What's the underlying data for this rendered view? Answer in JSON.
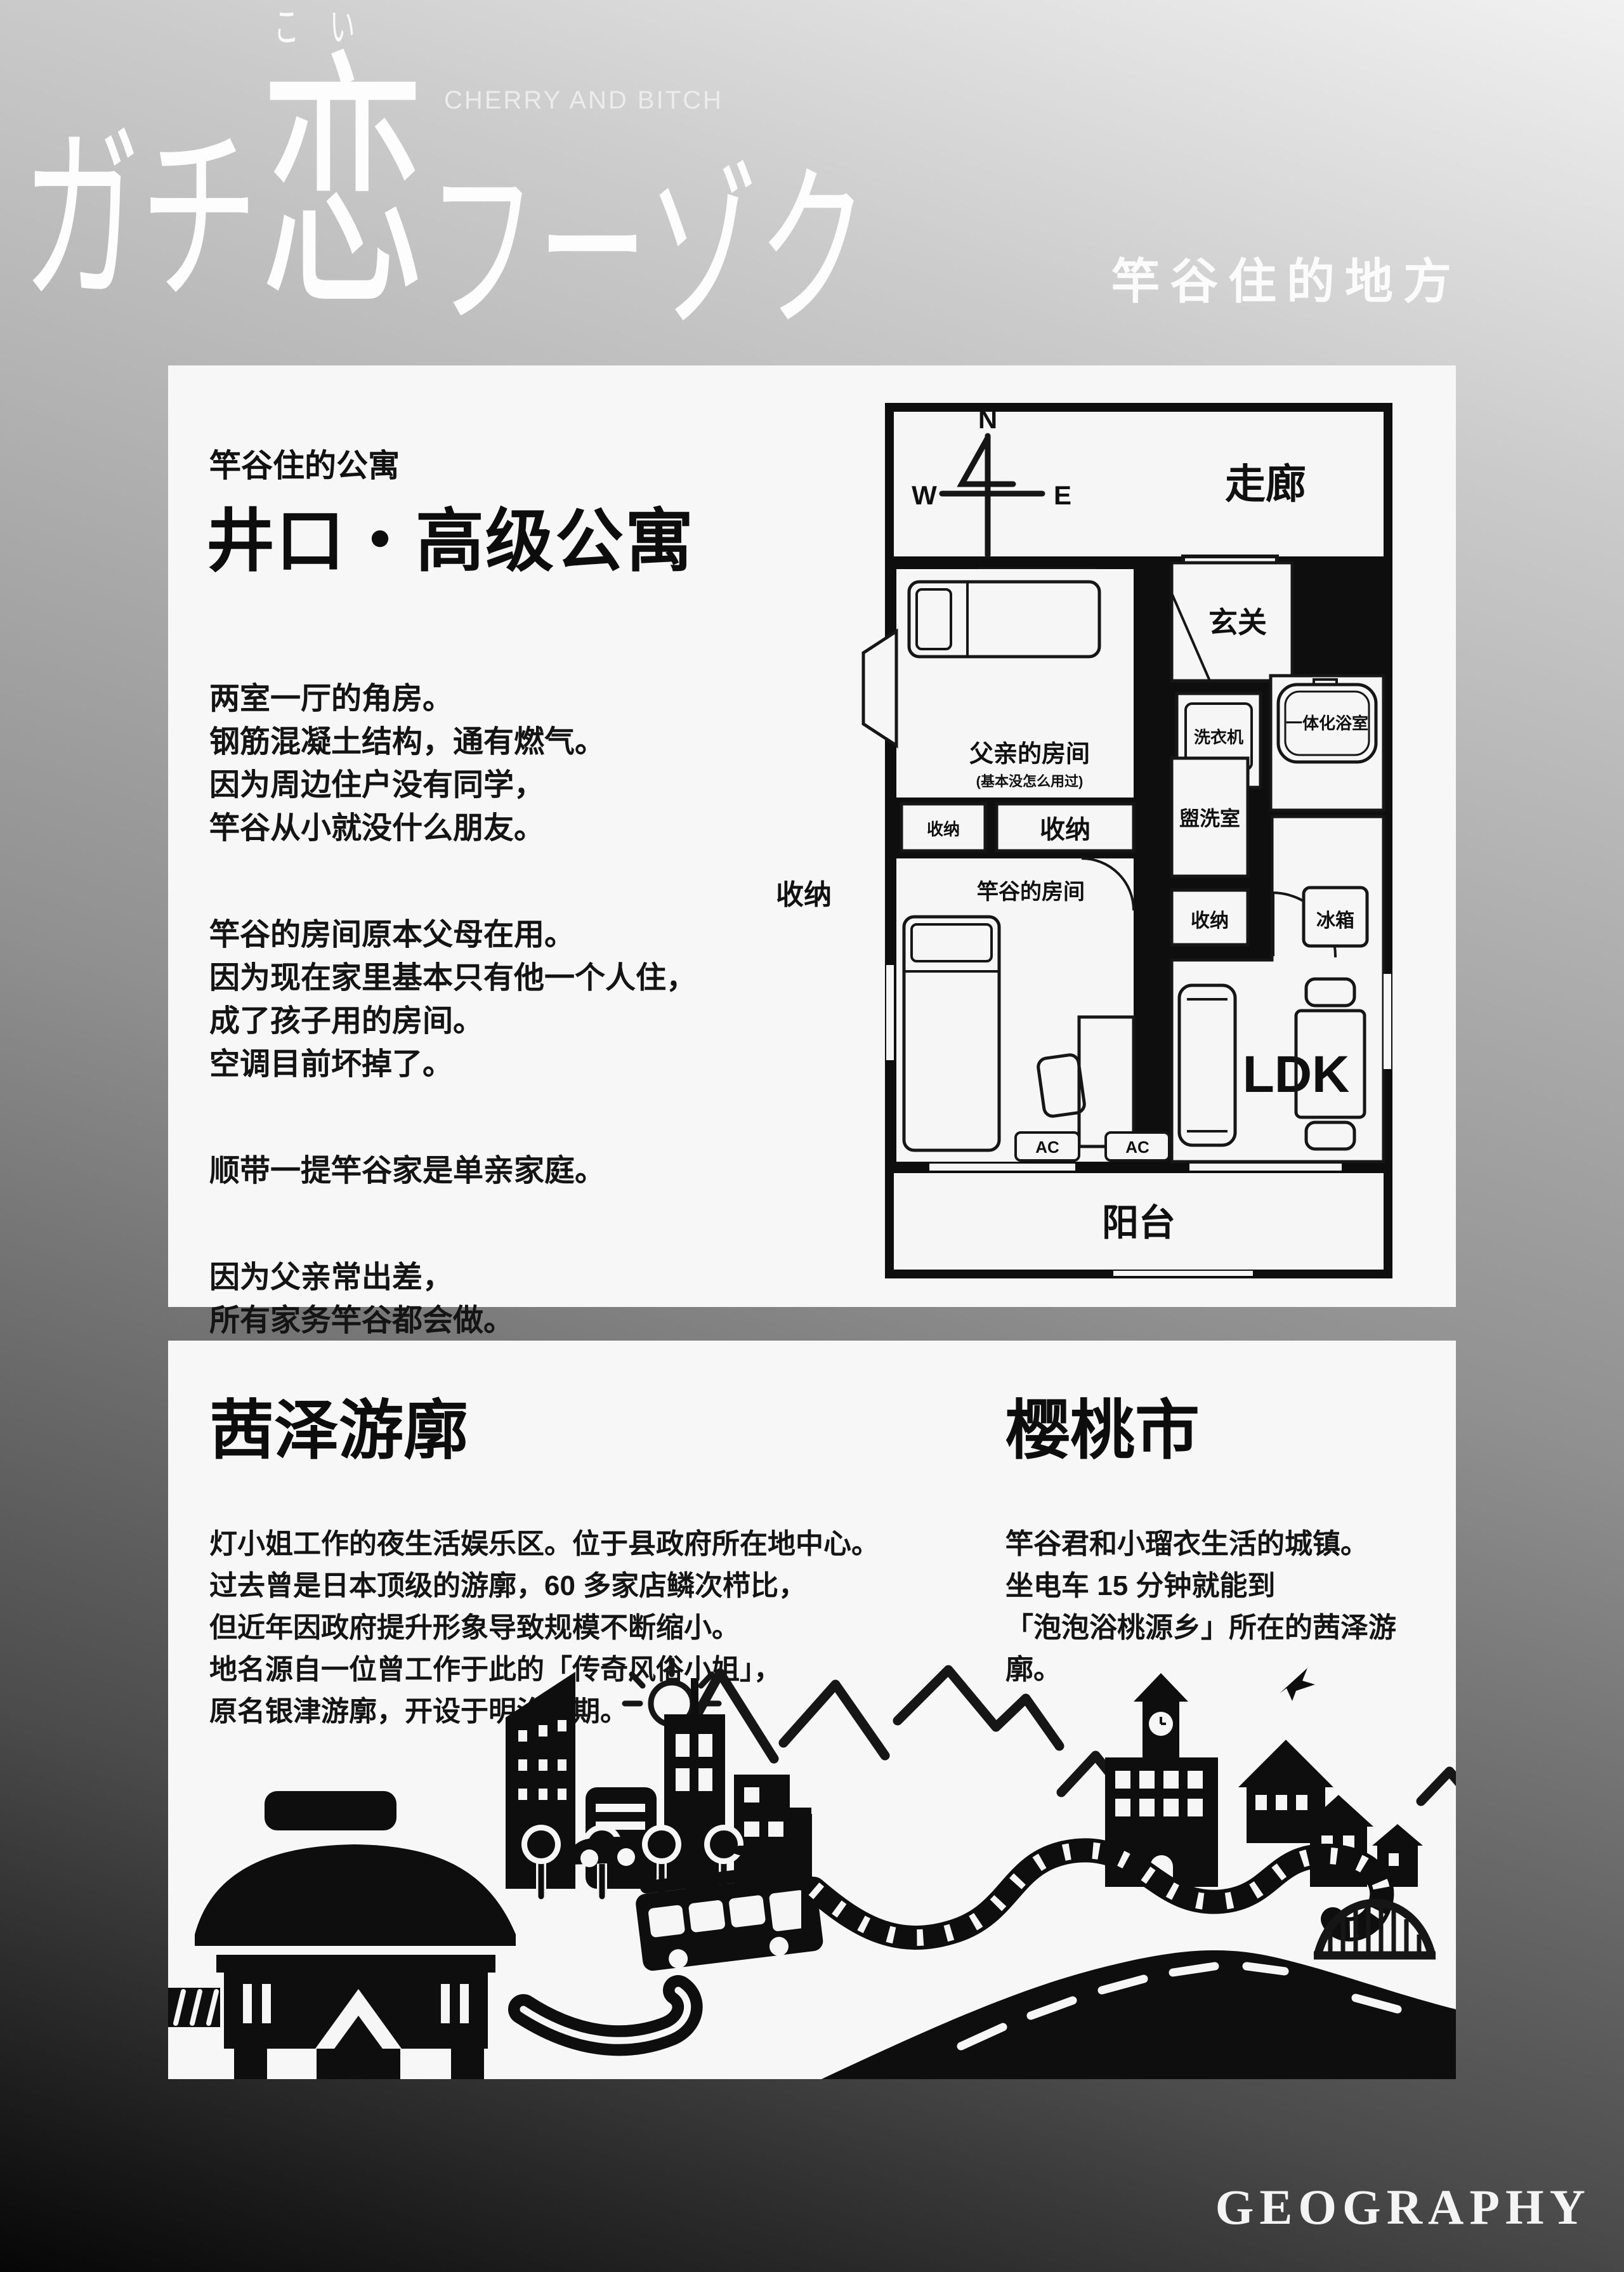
{
  "logo": {
    "furigana": "こい",
    "part1": "ガチ",
    "part2": "恋",
    "part3": "フーゾク",
    "subtitle": "CHERRY AND BITCH",
    "tagline": "竿谷住的地方"
  },
  "apartment_card": {
    "kicker": "竿谷住的公寓",
    "title": "井口・高级公寓",
    "paragraphs": {
      "p1": "两室一厅的角房。\n钢筋混凝土结构，通有燃气。\n因为周边住户没有同学，\n竿谷从小就没什么朋友。",
      "p2": "竿谷的房间原本父母在用。\n因为现在家里基本只有他一个人住，\n成了孩子用的房间。\n空调目前坏掉了。",
      "p3": "顺带一提竿谷家是单亲家庭。",
      "p4": "因为父亲常出差，\n所有家务竿谷都会做。\n购物是用的是专用的信用卡，\n最近苦于风俗店的开销，\n在犹豫要不要刷卡付钱。"
    },
    "floorplan": {
      "compass": {
        "n": "N",
        "e": "E",
        "s": "S",
        "w": "W"
      },
      "corridor": "走廊",
      "toilet": "厕所",
      "entrance": "玄关",
      "washer": "洗衣机",
      "unit_bath": "一体化浴室",
      "father_room": "父亲的房间",
      "father_note": "(基本没怎么用过)",
      "storage": "收纳",
      "my_room": "竿谷的房间",
      "washroom": "盥洗室",
      "fridge": "冰箱",
      "ldk": "LDK",
      "ac": "AC",
      "balcony": "阳台"
    }
  },
  "district_card": {
    "yukaku": {
      "title": "茜泽游廓",
      "body": "灯小姐工作的夜生活娱乐区。位于县政府所在地中心。\n过去曾是日本顶级的游廓，60 多家店鳞次栉比，\n但近年因政府提升形象导致规模不断缩小。\n地名源自一位曾工作于此的「传奇风俗小姐」，\n原名银津游廓，开设于明治中期。"
    },
    "city": {
      "title": "樱桃市",
      "body": "竿谷君和小瑠衣生活的城镇。\n坐电车 15 分钟就能到\n「泡泡浴桃源乡」所在的茜泽游廓。"
    },
    "illustration": {
      "onsen_mark": "♨"
    }
  },
  "footer": {
    "label": "GEOGRAPHY"
  }
}
